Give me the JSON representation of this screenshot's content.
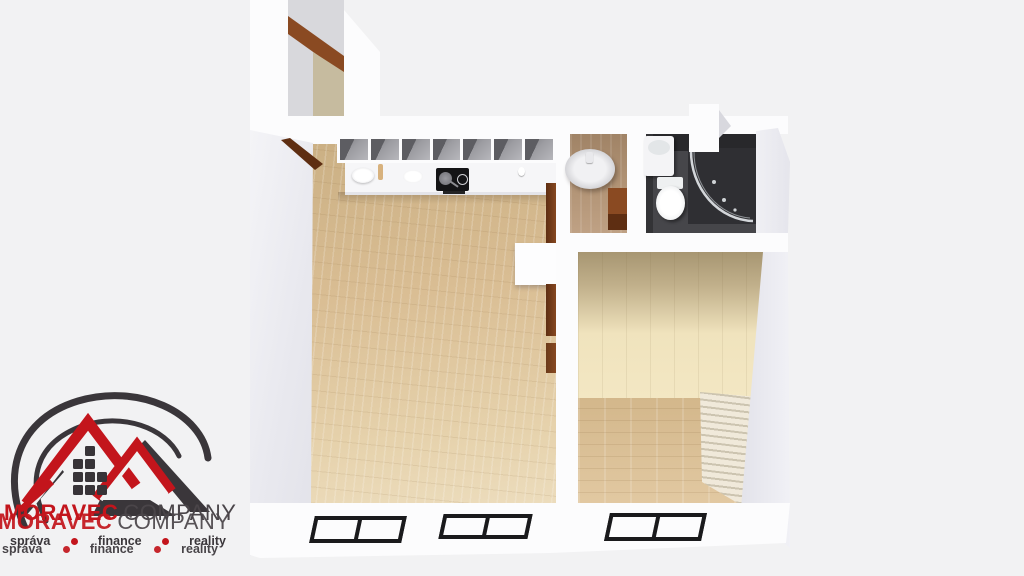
{
  "watermark": {
    "brand_primary": "MORAVEC",
    "brand_secondary": "COMPANY",
    "services": [
      "správa",
      "finance",
      "reality"
    ]
  },
  "colors": {
    "bg": "#f2f2f3",
    "wall": "#fcfcfd",
    "corridor_shade": "#d8d8dc",
    "beige": "#c6bb9f",
    "wood": "#d9bd93",
    "wood_dark": "#cbb084",
    "wood_light": "#ecdcbc",
    "tan_floor": "#b29476",
    "platform": "#f0e3bd",
    "platform_top": "#a79672",
    "bath_floor": "#46464a",
    "bath_wall": "#28282b",
    "shower_dark": "#2f2f33",
    "door_wood": "#8a4a22",
    "door_wood_dark": "#5e2e12",
    "frame": "#1a1a1c",
    "stair": "#f0e9da",
    "stair_line": "#ccc4b0",
    "brand_red": "#c3151c",
    "brand_dark": "#3a363a",
    "chrome": "#d3d6da"
  }
}
